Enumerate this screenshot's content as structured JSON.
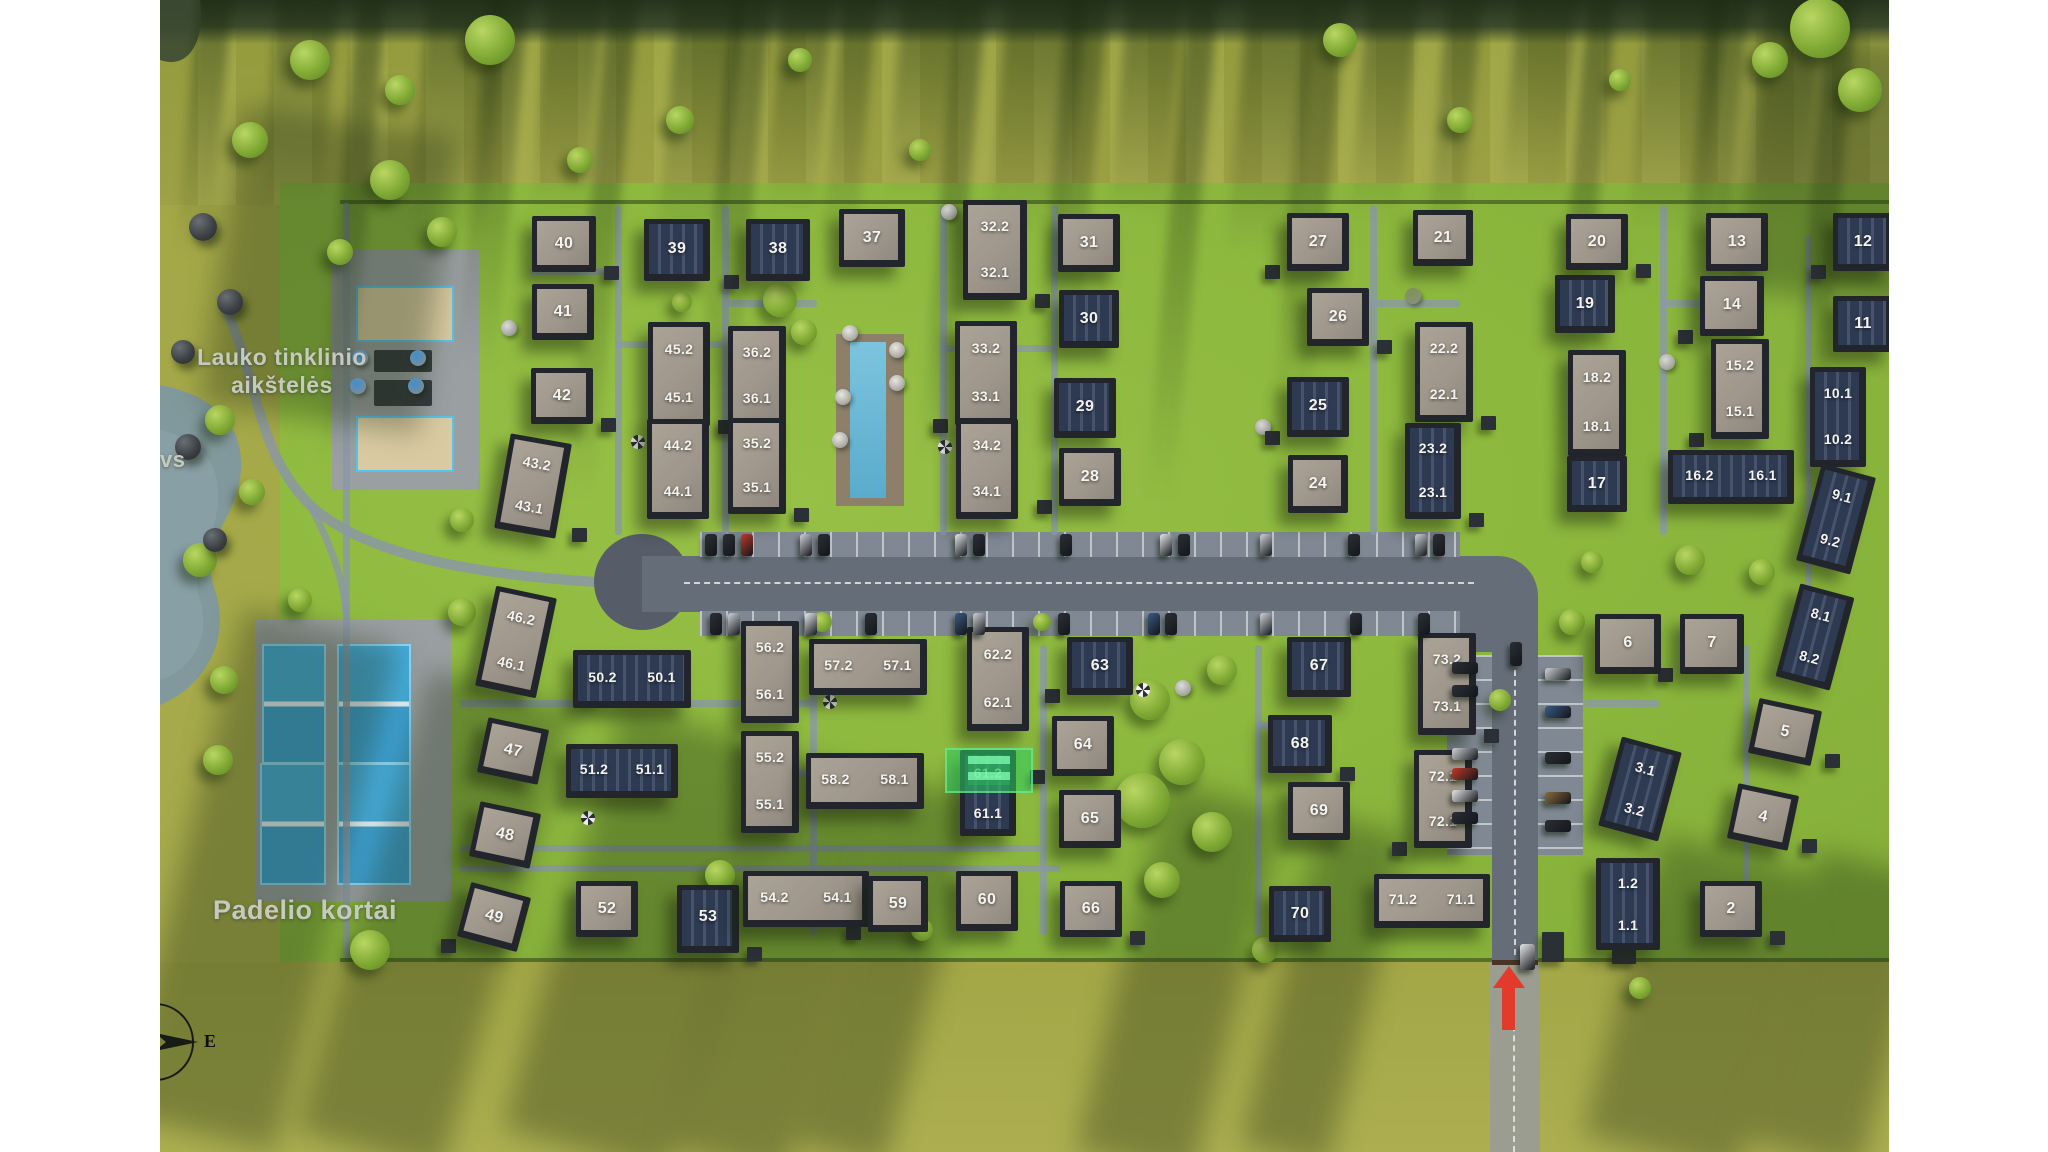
{
  "map": {
    "region_labels": {
      "volleyball_line1": "Lauko tinklinio",
      "volleyball_line2": "aikštelės",
      "padel": "Padelio kortai",
      "pond_label_partial": "vs",
      "compass_east": "E"
    },
    "selected_plot": "61.2",
    "highlight_color": "#2ccd62",
    "arrow_color": "#e23a2b",
    "plots": [
      {
        "id": "40",
        "x": 404,
        "y": 244,
        "w": 64,
        "h": 56,
        "r": 0,
        "roof": "light",
        "labels": [
          "40"
        ],
        "arr": "s"
      },
      {
        "id": "39",
        "x": 517,
        "y": 250,
        "w": 66,
        "h": 62,
        "r": 0,
        "roof": "dark",
        "labels": [
          "39"
        ],
        "arr": "s"
      },
      {
        "id": "38",
        "x": 618,
        "y": 250,
        "w": 64,
        "h": 62,
        "r": 0,
        "roof": "dark",
        "labels": [
          "38"
        ],
        "arr": "s"
      },
      {
        "id": "37",
        "x": 712,
        "y": 238,
        "w": 66,
        "h": 58,
        "r": 0,
        "roof": "light",
        "labels": [
          "37"
        ],
        "arr": "s"
      },
      {
        "id": "32",
        "x": 835,
        "y": 250,
        "w": 64,
        "h": 100,
        "r": 0,
        "roof": "light",
        "labels": [
          "32.2",
          "32.1"
        ],
        "arr": "v"
      },
      {
        "id": "31",
        "x": 929,
        "y": 243,
        "w": 62,
        "h": 58,
        "r": 0,
        "roof": "light",
        "labels": [
          "31"
        ],
        "arr": "s"
      },
      {
        "id": "27",
        "x": 1158,
        "y": 242,
        "w": 62,
        "h": 58,
        "r": 0,
        "roof": "light",
        "labels": [
          "27"
        ],
        "arr": "s"
      },
      {
        "id": "21",
        "x": 1283,
        "y": 238,
        "w": 60,
        "h": 56,
        "r": 0,
        "roof": "light",
        "labels": [
          "21"
        ],
        "arr": "s"
      },
      {
        "id": "20",
        "x": 1437,
        "y": 242,
        "w": 62,
        "h": 56,
        "r": 0,
        "roof": "light",
        "labels": [
          "20"
        ],
        "arr": "s"
      },
      {
        "id": "13",
        "x": 1577,
        "y": 242,
        "w": 62,
        "h": 58,
        "r": 0,
        "roof": "light",
        "labels": [
          "13"
        ],
        "arr": "s"
      },
      {
        "id": "12",
        "x": 1703,
        "y": 242,
        "w": 60,
        "h": 58,
        "r": 0,
        "roof": "dark",
        "labels": [
          "12"
        ],
        "arr": "s"
      },
      {
        "id": "41",
        "x": 403,
        "y": 312,
        "w": 62,
        "h": 56,
        "r": 0,
        "roof": "light",
        "labels": [
          "41"
        ],
        "arr": "s"
      },
      {
        "id": "26",
        "x": 1178,
        "y": 317,
        "w": 62,
        "h": 58,
        "r": 0,
        "roof": "light",
        "labels": [
          "26"
        ],
        "arr": "s"
      },
      {
        "id": "19",
        "x": 1425,
        "y": 304,
        "w": 60,
        "h": 58,
        "r": 0,
        "roof": "dark",
        "labels": [
          "19"
        ],
        "arr": "s"
      },
      {
        "id": "14",
        "x": 1572,
        "y": 306,
        "w": 64,
        "h": 60,
        "r": 0,
        "roof": "light",
        "labels": [
          "14"
        ],
        "arr": "s"
      },
      {
        "id": "11",
        "x": 1703,
        "y": 324,
        "w": 60,
        "h": 56,
        "r": 0,
        "roof": "dark",
        "labels": [
          "11"
        ],
        "arr": "s"
      },
      {
        "id": "45",
        "x": 519,
        "y": 374,
        "w": 62,
        "h": 104,
        "r": 0,
        "roof": "light",
        "labels": [
          "45.2",
          "45.1"
        ],
        "arr": "v"
      },
      {
        "id": "36",
        "x": 597,
        "y": 376,
        "w": 58,
        "h": 100,
        "r": 0,
        "roof": "light",
        "labels": [
          "36.2",
          "36.1"
        ],
        "arr": "v"
      },
      {
        "id": "33",
        "x": 826,
        "y": 373,
        "w": 62,
        "h": 104,
        "r": 0,
        "roof": "light",
        "labels": [
          "33.2",
          "33.1"
        ],
        "arr": "v"
      },
      {
        "id": "30",
        "x": 929,
        "y": 319,
        "w": 60,
        "h": 58,
        "r": 0,
        "roof": "dark",
        "labels": [
          "30"
        ],
        "arr": "s"
      },
      {
        "id": "22",
        "x": 1284,
        "y": 372,
        "w": 58,
        "h": 100,
        "r": 0,
        "roof": "light",
        "labels": [
          "22.2",
          "22.1"
        ],
        "arr": "v"
      },
      {
        "id": "18",
        "x": 1437,
        "y": 403,
        "w": 58,
        "h": 106,
        "r": 0,
        "roof": "light",
        "labels": [
          "18.2",
          "18.1"
        ],
        "arr": "v"
      },
      {
        "id": "15",
        "x": 1580,
        "y": 389,
        "w": 58,
        "h": 100,
        "r": 0,
        "roof": "light",
        "labels": [
          "15.2",
          "15.1"
        ],
        "arr": "v"
      },
      {
        "id": "10",
        "x": 1678,
        "y": 417,
        "w": 56,
        "h": 100,
        "r": 0,
        "roof": "dark",
        "labels": [
          "10.1",
          "10.2"
        ],
        "arr": "v"
      },
      {
        "id": "42",
        "x": 402,
        "y": 396,
        "w": 62,
        "h": 56,
        "r": 0,
        "roof": "light",
        "labels": [
          "42"
        ],
        "arr": "s"
      },
      {
        "id": "29",
        "x": 925,
        "y": 408,
        "w": 62,
        "h": 60,
        "r": 0,
        "roof": "dark",
        "labels": [
          "29"
        ],
        "arr": "s"
      },
      {
        "id": "25",
        "x": 1158,
        "y": 407,
        "w": 62,
        "h": 60,
        "r": 0,
        "roof": "dark",
        "labels": [
          "25"
        ],
        "arr": "s"
      },
      {
        "id": "44",
        "x": 518,
        "y": 469,
        "w": 62,
        "h": 100,
        "r": 0,
        "roof": "light",
        "labels": [
          "44.2",
          "44.1"
        ],
        "arr": "v"
      },
      {
        "id": "35",
        "x": 597,
        "y": 466,
        "w": 58,
        "h": 96,
        "r": 0,
        "roof": "light",
        "labels": [
          "35.2",
          "35.1"
        ],
        "arr": "v"
      },
      {
        "id": "34",
        "x": 827,
        "y": 469,
        "w": 62,
        "h": 100,
        "r": 0,
        "roof": "light",
        "labels": [
          "34.2",
          "34.1"
        ],
        "arr": "v"
      },
      {
        "id": "28",
        "x": 930,
        "y": 477,
        "w": 62,
        "h": 58,
        "r": 0,
        "roof": "light",
        "labels": [
          "28"
        ],
        "arr": "s"
      },
      {
        "id": "24",
        "x": 1158,
        "y": 484,
        "w": 60,
        "h": 58,
        "r": 0,
        "roof": "light",
        "labels": [
          "24"
        ],
        "arr": "s"
      },
      {
        "id": "23",
        "x": 1273,
        "y": 471,
        "w": 56,
        "h": 96,
        "r": 0,
        "roof": "dark",
        "labels": [
          "23.2",
          "23.1"
        ],
        "arr": "v"
      },
      {
        "id": "17",
        "x": 1437,
        "y": 484,
        "w": 60,
        "h": 56,
        "r": 0,
        "roof": "dark",
        "labels": [
          "17"
        ],
        "arr": "s"
      },
      {
        "id": "16",
        "x": 1571,
        "y": 477,
        "w": 126,
        "h": 54,
        "r": 0,
        "roof": "dark",
        "labels": [
          "16.2",
          "16.1"
        ],
        "arr": "h"
      },
      {
        "id": "9",
        "x": 1676,
        "y": 519,
        "w": 56,
        "h": 100,
        "r": 15,
        "roof": "dark",
        "labels": [
          "9.1",
          "9.2"
        ],
        "arr": "v"
      },
      {
        "id": "43",
        "x": 373,
        "y": 486,
        "w": 62,
        "h": 96,
        "r": 10,
        "roof": "light",
        "labels": [
          "43.2",
          "43.1"
        ],
        "arr": "v"
      },
      {
        "id": "46",
        "x": 356,
        "y": 642,
        "w": 62,
        "h": 102,
        "r": 12,
        "roof": "light",
        "labels": [
          "46.2",
          "46.1"
        ],
        "arr": "v"
      },
      {
        "id": "50",
        "x": 472,
        "y": 679,
        "w": 118,
        "h": 58,
        "r": 0,
        "roof": "dark",
        "labels": [
          "50.2",
          "50.1"
        ],
        "arr": "h"
      },
      {
        "id": "56",
        "x": 610,
        "y": 672,
        "w": 58,
        "h": 102,
        "r": 0,
        "roof": "light",
        "labels": [
          "56.2",
          "56.1"
        ],
        "arr": "v"
      },
      {
        "id": "57",
        "x": 708,
        "y": 667,
        "w": 118,
        "h": 56,
        "r": 0,
        "roof": "light",
        "labels": [
          "57.2",
          "57.1"
        ],
        "arr": "h"
      },
      {
        "id": "62",
        "x": 838,
        "y": 679,
        "w": 62,
        "h": 104,
        "r": 0,
        "roof": "light",
        "labels": [
          "62.2",
          "62.1"
        ],
        "arr": "v"
      },
      {
        "id": "63",
        "x": 940,
        "y": 666,
        "w": 66,
        "h": 58,
        "r": 0,
        "roof": "dark",
        "labels": [
          "63"
        ],
        "arr": "s"
      },
      {
        "id": "67",
        "x": 1159,
        "y": 667,
        "w": 64,
        "h": 60,
        "r": 0,
        "roof": "dark",
        "labels": [
          "67"
        ],
        "arr": "s"
      },
      {
        "id": "73",
        "x": 1287,
        "y": 684,
        "w": 58,
        "h": 102,
        "r": 0,
        "roof": "light",
        "labels": [
          "73.2",
          "73.1"
        ],
        "arr": "v"
      },
      {
        "id": "6",
        "x": 1468,
        "y": 644,
        "w": 66,
        "h": 60,
        "r": 0,
        "roof": "light",
        "labels": [
          "6"
        ],
        "arr": "s"
      },
      {
        "id": "7",
        "x": 1552,
        "y": 644,
        "w": 64,
        "h": 60,
        "r": 0,
        "roof": "light",
        "labels": [
          "7"
        ],
        "arr": "s"
      },
      {
        "id": "8",
        "x": 1655,
        "y": 637,
        "w": 56,
        "h": 96,
        "r": 15,
        "roof": "dark",
        "labels": [
          "8.1",
          "8.2"
        ],
        "arr": "v"
      },
      {
        "id": "5",
        "x": 1625,
        "y": 732,
        "w": 64,
        "h": 56,
        "r": 12,
        "roof": "light",
        "labels": [
          "5"
        ],
        "arr": "s"
      },
      {
        "id": "47",
        "x": 353,
        "y": 751,
        "w": 62,
        "h": 56,
        "r": 12,
        "roof": "light",
        "labels": [
          "47"
        ],
        "arr": "s"
      },
      {
        "id": "51",
        "x": 462,
        "y": 771,
        "w": 112,
        "h": 54,
        "r": 0,
        "roof": "dark",
        "labels": [
          "51.2",
          "51.1"
        ],
        "arr": "h"
      },
      {
        "id": "55",
        "x": 610,
        "y": 782,
        "w": 58,
        "h": 102,
        "r": 0,
        "roof": "light",
        "labels": [
          "55.2",
          "55.1"
        ],
        "arr": "v"
      },
      {
        "id": "58",
        "x": 705,
        "y": 781,
        "w": 118,
        "h": 56,
        "r": 0,
        "roof": "light",
        "labels": [
          "58.2",
          "58.1"
        ],
        "arr": "h"
      },
      {
        "id": "61",
        "x": 828,
        "y": 793,
        "w": 56,
        "h": 86,
        "r": 0,
        "roof": "dark",
        "labels": [
          "61.2",
          "61.1"
        ],
        "arr": "v"
      },
      {
        "id": "64",
        "x": 923,
        "y": 746,
        "w": 62,
        "h": 60,
        "r": 0,
        "roof": "light",
        "labels": [
          "64"
        ],
        "arr": "s"
      },
      {
        "id": "65",
        "x": 930,
        "y": 819,
        "w": 62,
        "h": 58,
        "r": 0,
        "roof": "light",
        "labels": [
          "65"
        ],
        "arr": "s"
      },
      {
        "id": "68",
        "x": 1140,
        "y": 744,
        "w": 64,
        "h": 58,
        "r": 0,
        "roof": "dark",
        "labels": [
          "68"
        ],
        "arr": "s"
      },
      {
        "id": "69",
        "x": 1159,
        "y": 811,
        "w": 62,
        "h": 58,
        "r": 0,
        "roof": "light",
        "labels": [
          "69"
        ],
        "arr": "s"
      },
      {
        "id": "72",
        "x": 1283,
        "y": 799,
        "w": 58,
        "h": 98,
        "r": 0,
        "roof": "light",
        "labels": [
          "72.1",
          "72.1"
        ],
        "arr": "v"
      },
      {
        "id": "3",
        "x": 1480,
        "y": 789,
        "w": 62,
        "h": 92,
        "r": 15,
        "roof": "dark",
        "labels": [
          "3.1",
          "3.2"
        ],
        "arr": "v"
      },
      {
        "id": "4",
        "x": 1603,
        "y": 817,
        "w": 62,
        "h": 56,
        "r": 12,
        "roof": "light",
        "labels": [
          "4"
        ],
        "arr": "s"
      },
      {
        "id": "48",
        "x": 345,
        "y": 835,
        "w": 62,
        "h": 56,
        "r": 12,
        "roof": "light",
        "labels": [
          "48"
        ],
        "arr": "s"
      },
      {
        "id": "49",
        "x": 334,
        "y": 917,
        "w": 62,
        "h": 56,
        "r": 15,
        "roof": "light",
        "labels": [
          "49"
        ],
        "arr": "s"
      },
      {
        "id": "52",
        "x": 447,
        "y": 909,
        "w": 62,
        "h": 56,
        "r": 0,
        "roof": "light",
        "labels": [
          "52"
        ],
        "arr": "s"
      },
      {
        "id": "53",
        "x": 548,
        "y": 919,
        "w": 62,
        "h": 68,
        "r": 0,
        "roof": "dark",
        "labels": [
          "53"
        ],
        "arr": "s"
      },
      {
        "id": "54",
        "x": 646,
        "y": 899,
        "w": 126,
        "h": 56,
        "r": 0,
        "roof": "light",
        "labels": [
          "54.2",
          "54.1"
        ],
        "arr": "h"
      },
      {
        "id": "59",
        "x": 738,
        "y": 904,
        "w": 60,
        "h": 56,
        "r": 0,
        "roof": "light",
        "labels": [
          "59"
        ],
        "arr": "s"
      },
      {
        "id": "60",
        "x": 827,
        "y": 901,
        "w": 62,
        "h": 60,
        "r": 0,
        "roof": "light",
        "labels": [
          "60"
        ],
        "arr": "s"
      },
      {
        "id": "66",
        "x": 931,
        "y": 909,
        "w": 62,
        "h": 56,
        "r": 0,
        "roof": "light",
        "labels": [
          "66"
        ],
        "arr": "s"
      },
      {
        "id": "70",
        "x": 1140,
        "y": 914,
        "w": 62,
        "h": 56,
        "r": 0,
        "roof": "dark",
        "labels": [
          "70"
        ],
        "arr": "s"
      },
      {
        "id": "71",
        "x": 1272,
        "y": 901,
        "w": 116,
        "h": 54,
        "r": 0,
        "roof": "light",
        "labels": [
          "71.2",
          "71.1"
        ],
        "arr": "h"
      },
      {
        "id": "1",
        "x": 1468,
        "y": 904,
        "w": 64,
        "h": 92,
        "r": 0,
        "roof": "dark",
        "labels": [
          "1.2",
          "1.1"
        ],
        "arr": "v"
      },
      {
        "id": "2",
        "x": 1571,
        "y": 909,
        "w": 62,
        "h": 56,
        "r": 0,
        "roof": "light",
        "labels": [
          "2"
        ],
        "arr": "s"
      }
    ]
  }
}
